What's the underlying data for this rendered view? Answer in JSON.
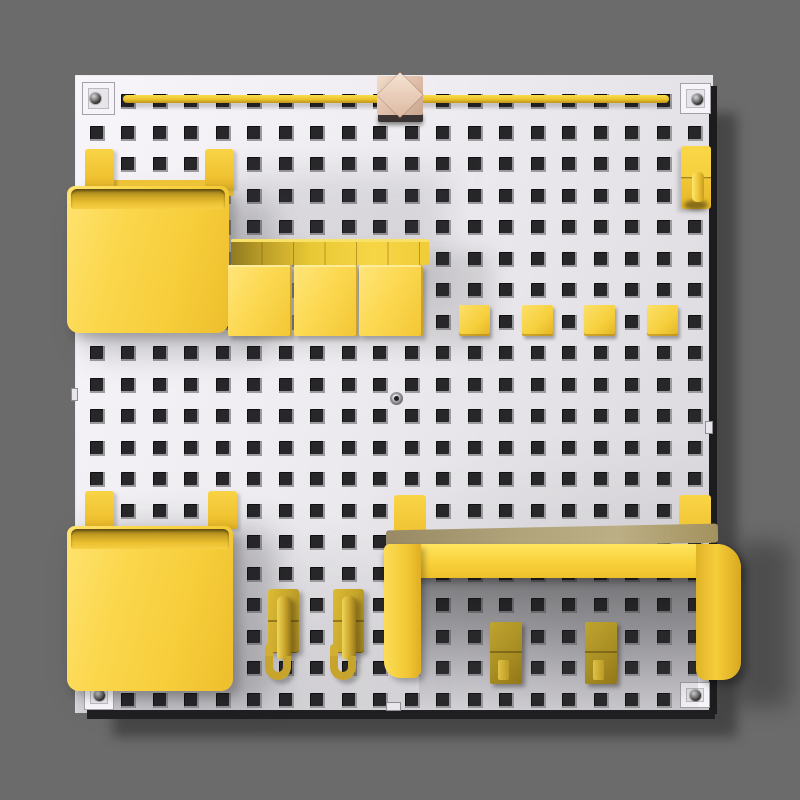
{
  "scene": {
    "description": "3D render of a square white pegboard mounted on a gray wall, organized with bright yellow accessories casting a hard drop shadow to the lower right",
    "background_color": "#6b6b6b",
    "board_shadow_color": "rgba(0,0,0,0.34)"
  },
  "board": {
    "fill": "#efedf1",
    "edge_color": "#1c1c1e",
    "grid": {
      "rows": 20,
      "cols": 20,
      "spacing": 31.5,
      "hole_size": 15,
      "offset_x": 13.5,
      "offset_y": 18,
      "hole_color": "#27272a"
    },
    "corner_screw_plates": 4,
    "center_screw": 1
  },
  "colors": {
    "accent": "#f9d23f",
    "accent_light": "#ffe36a",
    "accent_dark": "#d9a92a",
    "accent_olive": "#b2962a",
    "wood": "#dcbca9",
    "plate": "#f6f4f8"
  },
  "objects": {
    "top_rail": 1,
    "wood_cube_slider": 1,
    "storage_bins": 2,
    "bin_mount_tabs": 4,
    "tile_rack_segments": 6,
    "leaning_tiles": 3,
    "square_pegs": 4,
    "single_hook_top_right": 1,
    "j_hooks": 2,
    "shelf_bracket": 1,
    "shelf_mount_tabs": 2,
    "shelf_hook_plates": 2
  },
  "pegs_row": {
    "count": 4,
    "start_x": 383,
    "step": 62.7,
    "y": 229,
    "size": 31
  },
  "tiles_row": {
    "count": 3,
    "start_x": 152,
    "step": 65.5,
    "y": 189
  }
}
